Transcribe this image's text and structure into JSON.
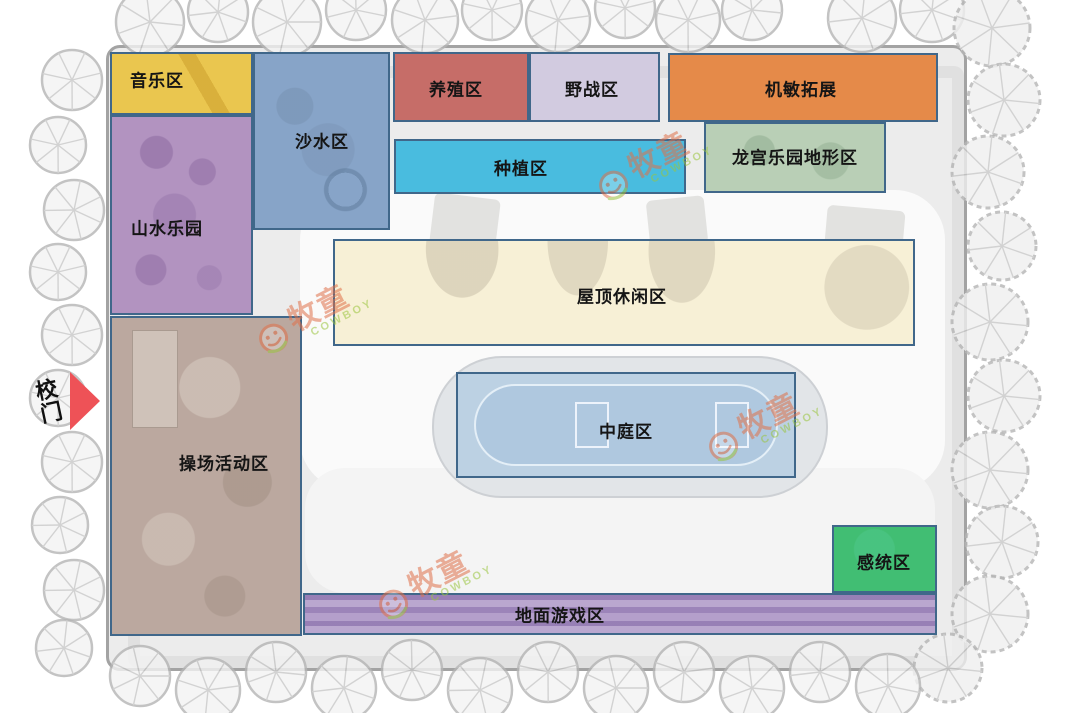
{
  "map": {
    "gate": {
      "label": "校门",
      "arrow_color": "#ee5257"
    },
    "watermark": {
      "text": "牧童",
      "subtext": "COWBOY",
      "text_color": "#e0714a",
      "subtext_color": "#9bc53f",
      "positions": [
        {
          "x": 652,
          "y": 165
        },
        {
          "x": 762,
          "y": 426
        },
        {
          "x": 312,
          "y": 318
        },
        {
          "x": 432,
          "y": 584
        }
      ]
    },
    "zones": [
      {
        "name": "music",
        "label": "音乐区",
        "fill": "#eac64f",
        "x": 110,
        "y": 52,
        "w": 143,
        "h": 63,
        "lx": 157,
        "ly": 79
      },
      {
        "name": "mountain-water-park",
        "label": "山水乐园",
        "fill": "#b293c0",
        "x": 110,
        "y": 115,
        "w": 143,
        "h": 200,
        "lx": 167,
        "ly": 227
      },
      {
        "name": "sand-water",
        "label": "沙水区",
        "fill": "#87a4c8",
        "x": 253,
        "y": 52,
        "w": 137,
        "h": 178,
        "lx": 322,
        "ly": 140
      },
      {
        "name": "breeding",
        "label": "养殖区",
        "fill": "#c66d68",
        "x": 393,
        "y": 52,
        "w": 136,
        "h": 70,
        "lx": 456,
        "ly": 88
      },
      {
        "name": "field-battle",
        "label": "野战区",
        "fill": "#d2cbe0",
        "x": 529,
        "y": 52,
        "w": 131,
        "h": 70,
        "lx": 592,
        "ly": 88
      },
      {
        "name": "agility-development",
        "label": "机敏拓展",
        "fill": "#e58a49",
        "x": 668,
        "y": 53,
        "w": 270,
        "h": 69,
        "lx": 801,
        "ly": 88
      },
      {
        "name": "planting",
        "label": "种植区",
        "fill": "#49bcdf",
        "x": 394,
        "y": 139,
        "w": 292,
        "h": 55,
        "lx": 521,
        "ly": 167
      },
      {
        "name": "dragon-palace",
        "label": "龙宫乐园地形区",
        "fill": "#b9cfb6",
        "x": 704,
        "y": 122,
        "w": 182,
        "h": 71,
        "lx": 795,
        "ly": 156
      },
      {
        "name": "rooftop-leisure",
        "label": "屋顶休闲区",
        "fill": "#f7f0d6",
        "x": 333,
        "y": 239,
        "w": 582,
        "h": 107,
        "lx": 622,
        "ly": 295
      },
      {
        "name": "atrium",
        "label": "中庭区",
        "fill": "#bcd1e3",
        "x": 456,
        "y": 372,
        "w": 340,
        "h": 106,
        "lx": 626,
        "ly": 430
      },
      {
        "name": "playground-activity",
        "label": "操场活动区",
        "fill": "#bba89f",
        "x": 110,
        "y": 316,
        "w": 192,
        "h": 320,
        "lx": 224,
        "ly": 462
      },
      {
        "name": "sensory",
        "label": "感统区",
        "fill": "#41be73",
        "x": 832,
        "y": 525,
        "w": 105,
        "h": 68,
        "lx": 884,
        "ly": 561
      },
      {
        "name": "ground-game",
        "label": "地面游戏区",
        "fill": "#ab94c5",
        "x": 303,
        "y": 593,
        "w": 634,
        "h": 42,
        "lx": 560,
        "ly": 614
      }
    ]
  }
}
